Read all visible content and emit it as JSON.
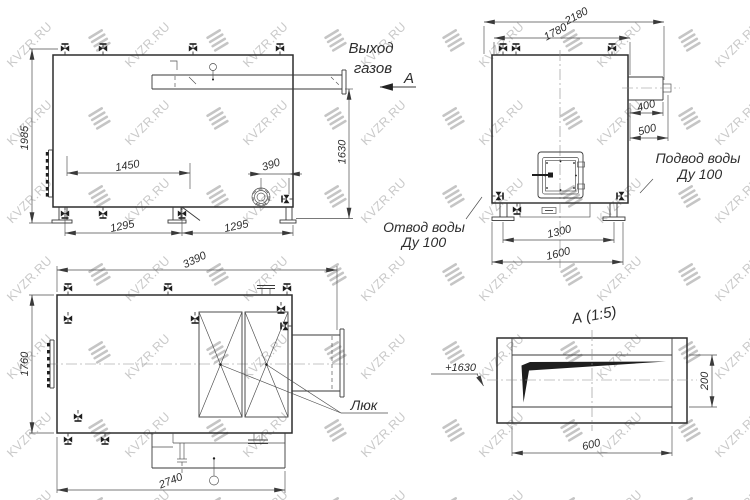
{
  "watermark": {
    "text": "KVZR.RU"
  },
  "side_view": {
    "gas_outlet_line1": "Выход",
    "gas_outlet_line2": "газов",
    "section_label": "А",
    "dim_height": "1985",
    "dim_outlet_height": "1630",
    "dim_1450": "1450",
    "dim_390": "390",
    "dim_1295_left": "1295",
    "dim_1295_right": "1295"
  },
  "front_view": {
    "dim_2180": "2180",
    "dim_1780": "1780",
    "dim_400": "400",
    "dim_500": "500",
    "dim_1300": "1300",
    "dim_1600": "1600",
    "water_supply_line1": "Подвод воды",
    "water_supply_line2": "Ду 100",
    "water_return_line1": "Отвод воды",
    "water_return_line2": "Ду 100"
  },
  "top_view": {
    "dim_3390": "3390",
    "dim_1760": "1760",
    "dim_2740": "2740",
    "hatch_label": "Люк"
  },
  "detail_view": {
    "title": "А (1:5)",
    "level_mark": "+1630",
    "dim_200": "200",
    "dim_600": "600"
  }
}
